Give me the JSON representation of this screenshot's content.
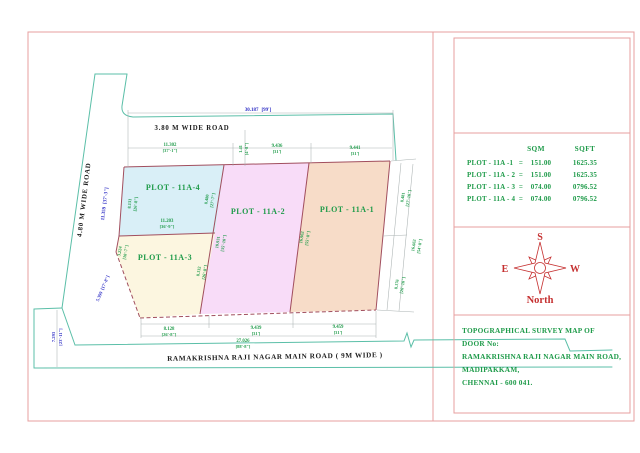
{
  "colors": {
    "plot1": "#f7dcc8",
    "plot2": "#f8dcf8",
    "plot3": "#fcf6e0",
    "plot4": "#d9eff7",
    "boundary_maroon": "#a14e5e",
    "survey_teal": "#5bbfa8",
    "dim_green": "#1f9b4a",
    "dim_blue": "#2b2bc4",
    "frame_pink": "#e79f9f",
    "compass_red": "#c53030"
  },
  "map": {
    "road_top": "3.80 M WIDE ROAD",
    "road_left": "4.80 M WIDE ROAD",
    "road_bottom": "RAMAKRISHNA RAJI NAGAR MAIN ROAD ( 9M WIDE )",
    "plots": [
      {
        "label": "PLOT - 11A-1"
      },
      {
        "label": "PLOT - 11A-2"
      },
      {
        "label": "PLOT - 11A-3"
      },
      {
        "label": "PLOT - 11A-4"
      }
    ],
    "dims": {
      "top_total": {
        "v": "30.187",
        "ft": "[99']"
      },
      "top_a": {
        "v": "11.302",
        "ft": "[37'-1\"]"
      },
      "top_gap": {
        "v": "1.41",
        "ft": "[4'-8\"]"
      },
      "top_b": {
        "v": "9.436",
        "ft": "[31']"
      },
      "top_c": {
        "v": "9.441",
        "ft": "[31']"
      },
      "left_road": {
        "v": "11.359",
        "ft": "[37'-3\"]"
      },
      "left_diag": {
        "v": "5.399",
        "ft": "[17'-8\"]"
      },
      "left_bot": {
        "v": "7.293",
        "ft": "[23'-11\"]"
      },
      "p4_left": {
        "v": "8.131",
        "ft": "[26'-8\"]"
      },
      "p4_right": {
        "v": "8.480",
        "ft": "[27'-7\"]"
      },
      "p4_bottom": {
        "v": "11.203",
        "ft": "[36'-9\"]"
      },
      "p3_left": {
        "v": "3.224",
        "ft": "[10'-7\"]"
      },
      "p3_right": {
        "v": "8.132",
        "ft": "[26'-8\"]"
      },
      "div_3_2": {
        "v": "10.931",
        "ft": "[35'-10\"]"
      },
      "div_2_1": {
        "v": "16.962",
        "ft": "[55'-8\"]"
      },
      "right_top": {
        "v": "8.481",
        "ft": "[27'-10\"]"
      },
      "right_mid": {
        "v": "16.662",
        "ft": "[54'-8\"]"
      },
      "right_bot": {
        "v": "8.176",
        "ft": "[26'-10\"]"
      },
      "bot_a": {
        "v": "8.128",
        "ft": "[26'-8\"]"
      },
      "bot_b": {
        "v": "9.439",
        "ft": "[31']"
      },
      "bot_c": {
        "v": "9.459",
        "ft": "[31']"
      },
      "bot_total": {
        "v": "27.026",
        "ft": "[88'-8\"]"
      }
    }
  },
  "panel": {
    "table": {
      "col_sqm": "SQM",
      "col_sqft": "SQFT",
      "rows": [
        {
          "label": "PLOT - 11A -1",
          "eq": "=",
          "sqm": "151.00",
          "sqft": "1625.35"
        },
        {
          "label": "PLOT - 11A - 2",
          "eq": "=",
          "sqm": "151.00",
          "sqft": "1625.35"
        },
        {
          "label": "PLOT - 11A - 3",
          "eq": "=",
          "sqm": "074.00",
          "sqft": "0796.52"
        },
        {
          "label": "PLOT - 11A - 4",
          "eq": "=",
          "sqm": "074.00",
          "sqft": "0796.52"
        }
      ]
    },
    "compass": {
      "top": "S",
      "left": "E",
      "right": "W",
      "bottom": "North"
    },
    "title": {
      "lines": [
        "TOPOGRAPHICAL SURVEY MAP OF",
        "DOOR No:",
        "RAMAKRISHNA RAJI NAGAR MAIN ROAD,",
        "MADIPAKKAM,",
        "CHENNAI - 600 041."
      ]
    }
  }
}
